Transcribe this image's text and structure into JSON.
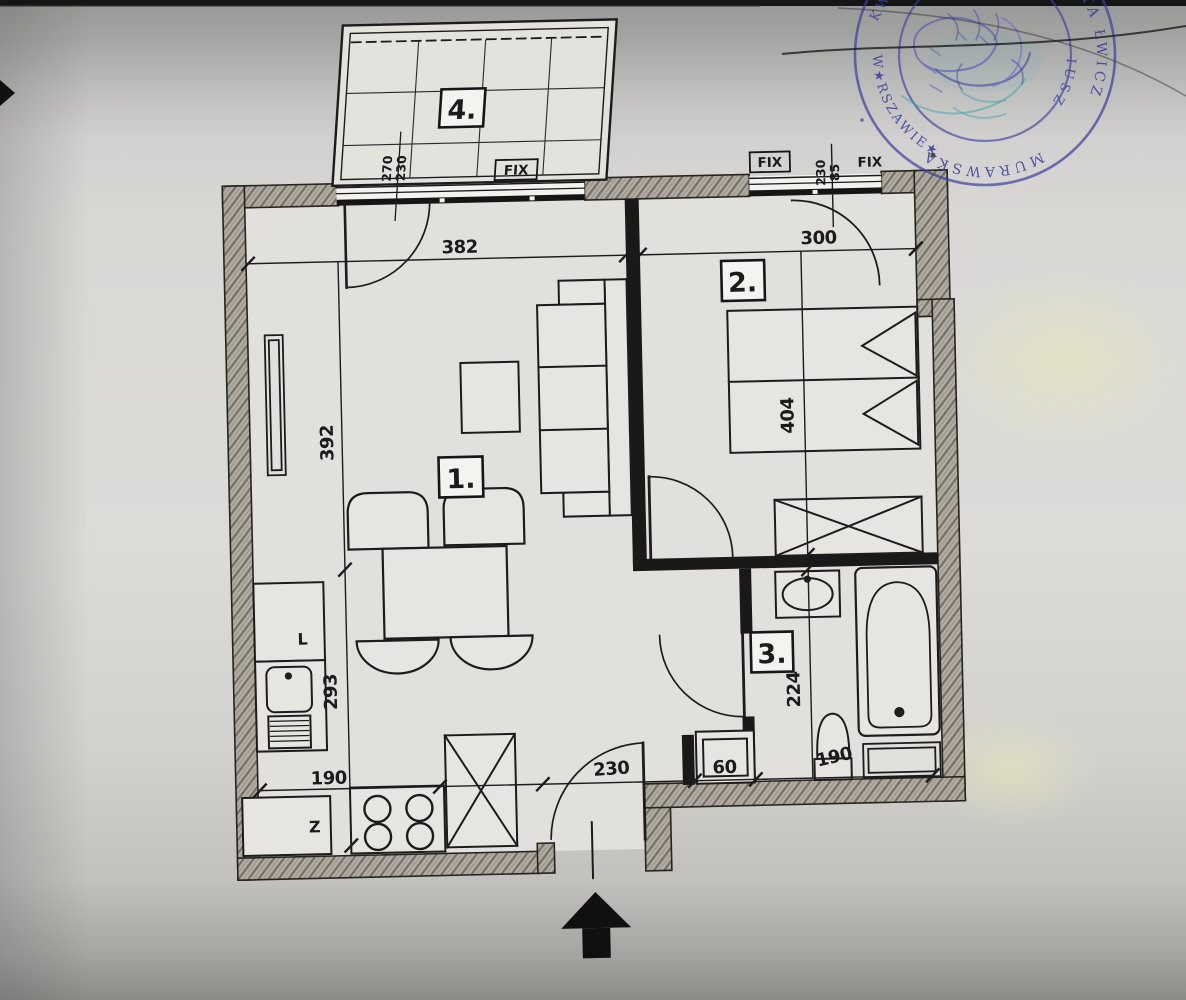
{
  "rooms": {
    "living": "1.",
    "bedroom": "2.",
    "bathroom": "3.",
    "balcony": "4."
  },
  "dims": {
    "living_width": "382",
    "living_height": "392",
    "kitchen_height": "293",
    "kitchen_width": "190",
    "bedroom_width": "300",
    "bedroom_height": "404",
    "bathroom_height": "224",
    "hall_width": "230",
    "washer_width": "60",
    "bathroom_width": "190"
  },
  "windows": {
    "fix": "FIX",
    "balcony_w": "270",
    "balcony_h": "230",
    "bedroom_w": "230",
    "bedroom_h": "85"
  },
  "kitchen": {
    "unit_l": "L",
    "unit_z": "Z"
  },
  "stamp": {
    "arc_left": "W★RSZAWIE★",
    "arc_bottom": "MURAWSKA",
    "arc_right": "TA ŁWICZ",
    "arc_right_inner": "IUSZ",
    "top_left": "KW"
  }
}
